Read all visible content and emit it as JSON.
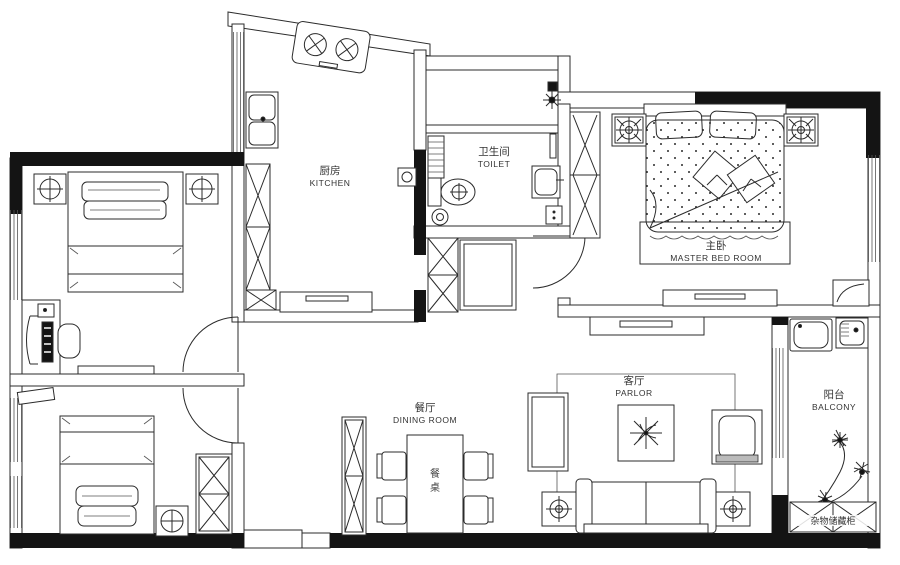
{
  "plan": {
    "title": "apartment-floor-plan",
    "colors": {
      "ink": "#2b2b2b",
      "wall_fill": "#141414",
      "paper": "#ffffff"
    },
    "rooms": {
      "kitchen": {
        "zh": "厨房",
        "en": "KITCHEN"
      },
      "toilet": {
        "zh": "卫生间",
        "en": "TOILET"
      },
      "master_bedroom": {
        "zh": "主卧",
        "en": "MASTER BED ROOM"
      },
      "dining_room": {
        "zh": "餐厅",
        "en": "DINING ROOM"
      },
      "parlor": {
        "zh": "客厅",
        "en": "PARLOR"
      },
      "balcony": {
        "zh": "阳台",
        "en": "BALCONY"
      }
    },
    "labels": {
      "dining_table_char_top": "餐",
      "dining_table_char_bottom": "桌",
      "storage_cabinet": "杂物储藏柜"
    }
  }
}
